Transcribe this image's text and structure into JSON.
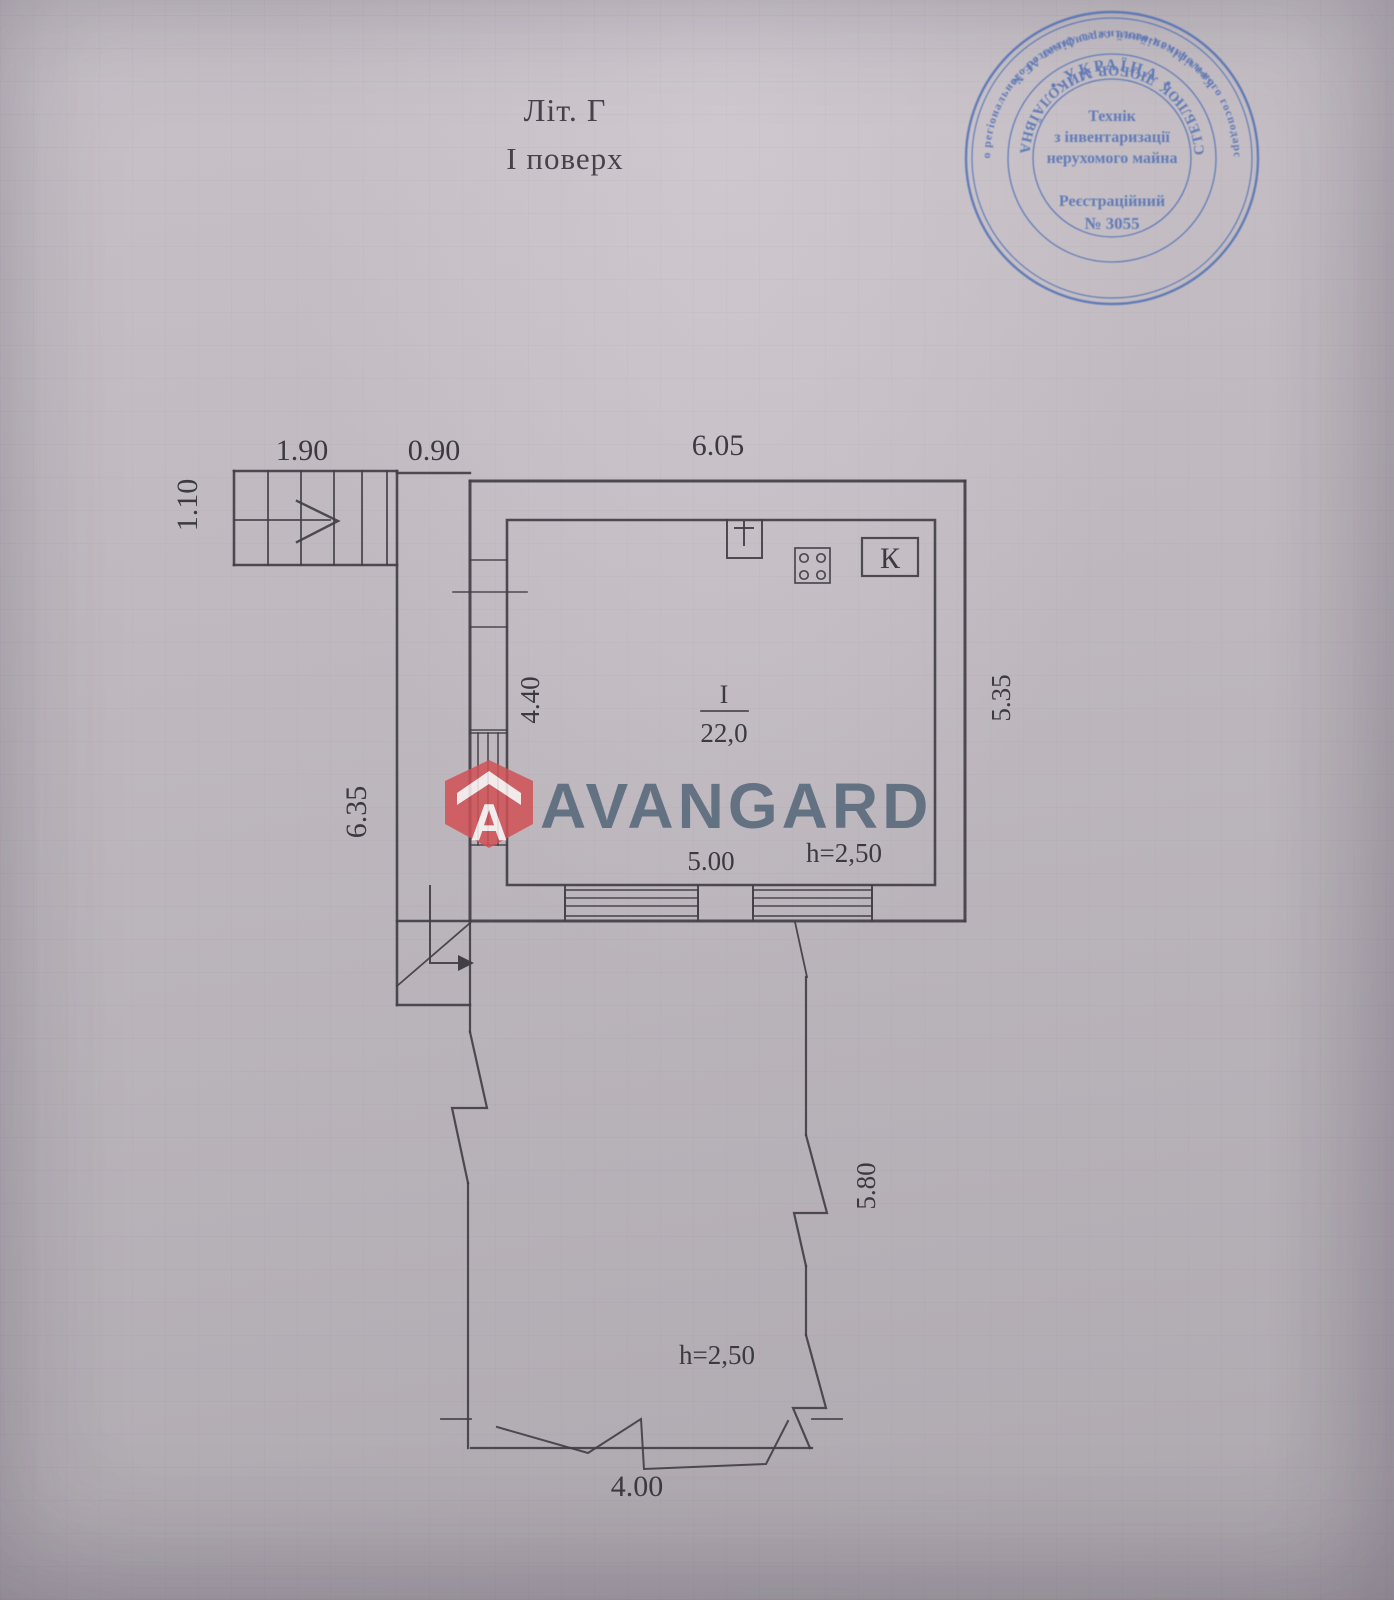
{
  "header": {
    "title_line1": "Літ. Г",
    "title_line2": "І поверх"
  },
  "stamp": {
    "outer_top": "Міністерство регіонального розвитку та житлово-комунального господарства України",
    "outer_bottom": "Кваліфікаційний сертифікат АЕ №",
    "country": "• УКРАЇНА •",
    "name": "СТЕБЛЮК ЛЮБОВ МИКОЛАЇВНА",
    "center_line1": "Технік",
    "center_line2": "з інвентаризації",
    "center_line3": "нерухомого майна",
    "center_line4": "Реєстраційний",
    "center_line5": "№ 3055",
    "ink_color": "#4c6cb4"
  },
  "watermark": {
    "brand": "AVANGARD",
    "logo_letter": "A",
    "brand_color": "#56687a",
    "logo_color": "#d05156"
  },
  "plan": {
    "room_number": "І",
    "room_area": "22,0",
    "kitchen_mark": "К",
    "dim_stairs_width": "1.90",
    "dim_gap": "0.90",
    "dim_top": "6.05",
    "dim_stairs_depth": "1.10",
    "dim_corridor": "6.35",
    "dim_room_left": "4.40",
    "dim_right": "5.35",
    "dim_room_bottom": "5.00",
    "room_height": "h=2,50",
    "dim_terrace_right": "5.80",
    "terrace_height": "h=2,50",
    "dim_terrace_bottom": "4.00"
  }
}
